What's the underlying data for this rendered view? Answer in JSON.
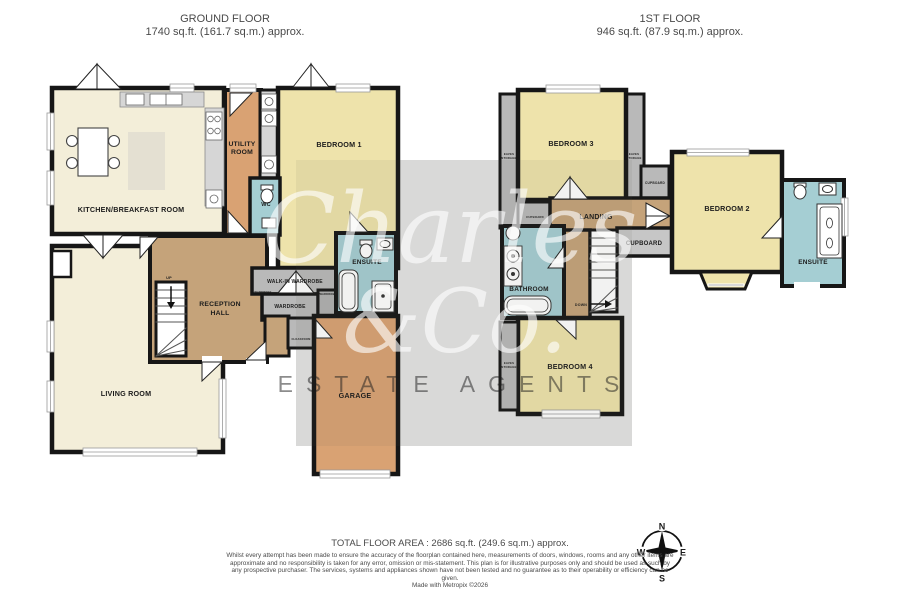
{
  "header": {
    "ground": {
      "title": "GROUND FLOOR",
      "area": "1740 sq.ft. (161.7 sq.m.) approx."
    },
    "first": {
      "title": "1ST FLOOR",
      "area": "946 sq.ft. (87.9 sq.m.) approx."
    }
  },
  "ground_floor": {
    "kitchen": "KITCHEN/BREAKFAST ROOM",
    "utility_l1": "UTILITY",
    "utility_l2": "ROOM",
    "bedroom1": "BEDROOM 1",
    "wc": "WC",
    "ensuite": "ENSUITE",
    "walk_in_wardrobe": "WALK-IN WARDROBE",
    "wardrobe_small_left": "WARDROBE",
    "wardrobe_small_right": "WARDROBE",
    "wardrobe": "WARDROBE",
    "reception_l1": "RECEPTION",
    "reception_l2": "HALL",
    "up": "UP",
    "living_room": "LIVING ROOM",
    "cloakroom": "CLOAKROOM",
    "garage": "GARAGE"
  },
  "first_floor": {
    "bedroom3": "BEDROOM 3",
    "eaves_left_l1": "EAVES",
    "eaves_left_l2": "STORAGE",
    "eaves_right_l1": "EAVES",
    "eaves_right_l2": "STORAGE",
    "cupboard_top": "CUPBOARD",
    "cupboard_left": "CUPBOARD",
    "landing": "LANDING",
    "cupboard_mid": "CUPBOARD",
    "bedroom2": "BEDROOM 2",
    "ensuite": "ENSUITE",
    "bathroom": "BATHROOM",
    "down": "DOWN",
    "eaves_b4_l1": "EAVES",
    "eaves_b4_l2": "STORAGE",
    "bedroom4": "BEDROOM 4"
  },
  "watermark": {
    "name_top": "Charles",
    "name_bottom": "&Co.",
    "tagline": "ESTATE AGENTS"
  },
  "compass": {
    "n": "N",
    "e": "E",
    "s": "S",
    "w": "W"
  },
  "footer": {
    "total": "TOTAL FLOOR AREA : 2686 sq.ft. (249.6 sq.m.) approx.",
    "disclaimer": "Whilst every attempt has been made to ensure the accuracy of the floorplan contained here, measurements of doors, windows, rooms and any other items are approximate and no responsibility is taken for any error, omission or mis-statement. This plan is for illustrative purposes only and should be used as such by any prospective purchaser. The services, systems and appliances shown have not been tested and no guarantee as to their operability or efficiency can be given.",
    "credit": "Made with Metropix ©2026"
  },
  "colors": {
    "floor_cream": "#f3eed9",
    "floor_yellow": "#eee3ab",
    "floor_orange": "#d9a273",
    "floor_tan": "#c5a37a",
    "floor_blue": "#a5ced3",
    "floor_gray": "#b9b9b9",
    "wall": "#161616",
    "watermark_bg": "#e4e4e4",
    "text_gray": "#4a4a4a"
  }
}
